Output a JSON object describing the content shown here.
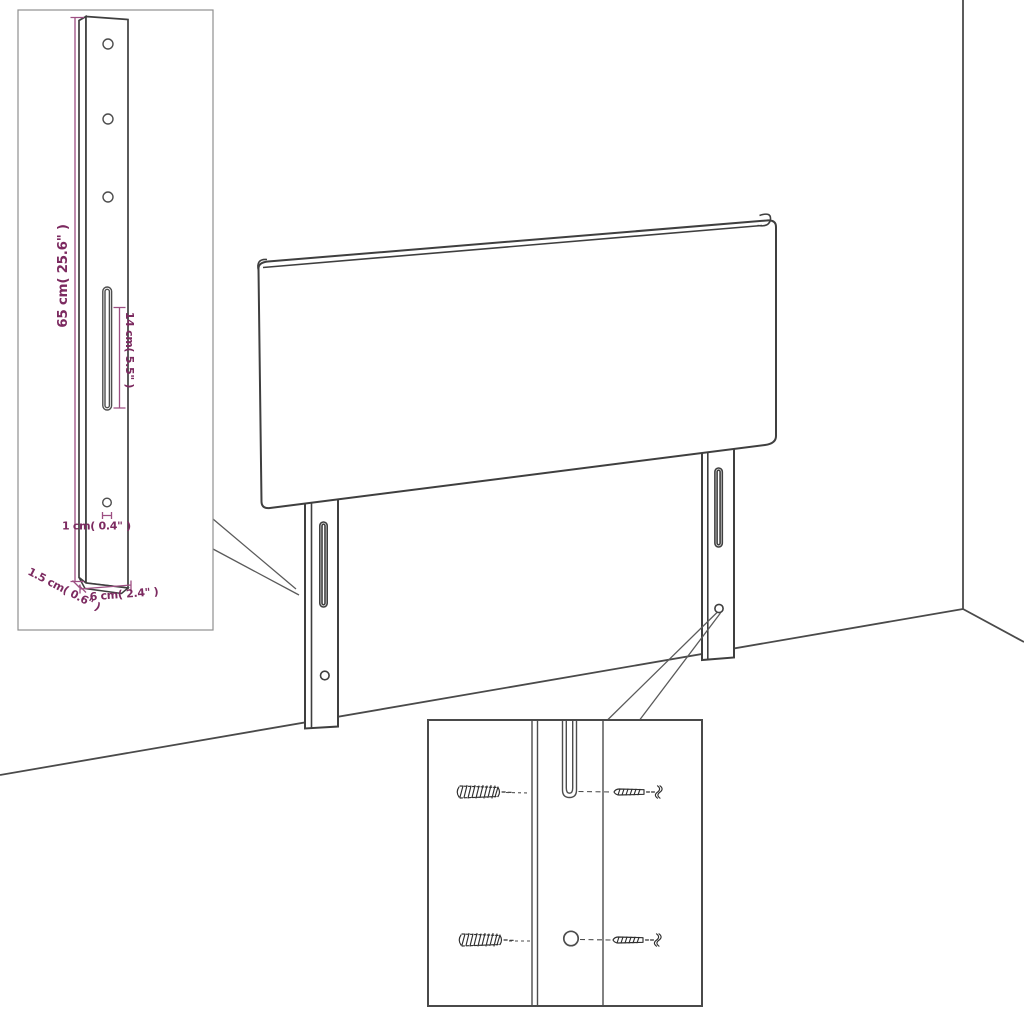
{
  "colors": {
    "outline": "#3f3f3f",
    "room_line": "#4a4a4a",
    "inset_border_light": "#8f8f8f",
    "inset_border_dark": "#4a4a4a",
    "dimension_line": "#9d4f82",
    "dimension_text": "#7c2a60",
    "background": "#ffffff"
  },
  "bracket_inset": {
    "labels": {
      "height": "65 cm( 25.6\" )",
      "slot_length": "14 cm( 5.5\" )",
      "hole_diameter": "1 cm( 0.4\" )",
      "thickness": "1.5 cm( 0.6\" )",
      "width": "6 cm( 2.4\" )"
    }
  }
}
